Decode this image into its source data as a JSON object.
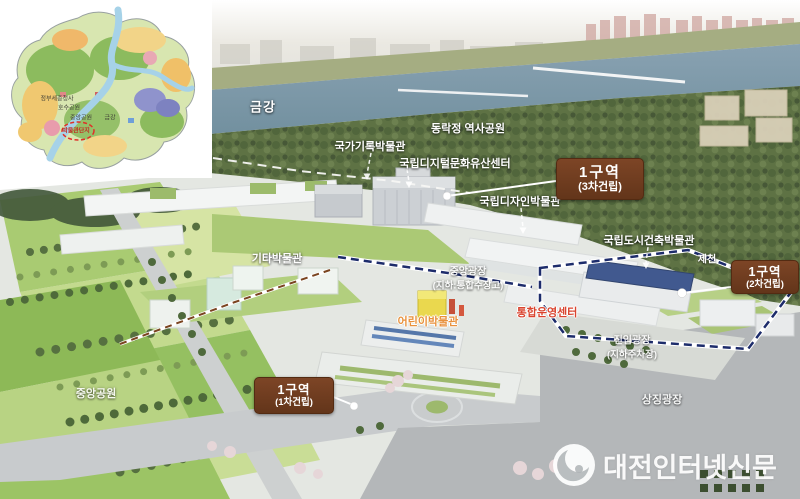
{
  "inset_map": {
    "labels": {
      "government_complex": "정부세종청사",
      "lake_park": "호수공원",
      "central_park": "중앙공원",
      "geum_river": "금강",
      "museum_complex": "박물관단지"
    }
  },
  "labels": {
    "geumgang": {
      "text": "금강"
    },
    "archives_museum": {
      "text": "국가기록박물관"
    },
    "dongnakjeong_park": {
      "text": "동락정 역사공원"
    },
    "digital_heritage_center": {
      "text": "국립디지털문화유산센터"
    },
    "design_museum": {
      "text": "국립디자인박물관"
    },
    "urban_architecture_museum": {
      "text": "국립도시건축박물관"
    },
    "jecheon": {
      "text": "제천"
    },
    "other_museums": {
      "text": "기타박물관"
    },
    "central_plaza": {
      "text": "중앙광장",
      "sub": "(지하:통합수장고)"
    },
    "children_museum": {
      "text": "어린이박물관"
    },
    "operation_center": {
      "text": "통합운영센터"
    },
    "entry_plaza": {
      "text": "진입광장",
      "sub": "(지하주차장)"
    },
    "central_park": {
      "text": "중앙공원"
    },
    "symbol_plaza": {
      "text": "상징광장"
    }
  },
  "zones": {
    "phase3": {
      "title": "1구역",
      "sub": "(3차건립)"
    },
    "phase2": {
      "title": "1구역",
      "sub": "(2차건립)"
    },
    "phase1": {
      "title": "1구역",
      "sub": "(1차건립)"
    }
  },
  "watermark": {
    "text": "대전인터넷신문"
  },
  "colors": {
    "zone_box": "#6e3a1c",
    "boundary_navy": "#1d2c6b",
    "label_orange": "#e8913c",
    "label_red": "#d9442f",
    "river": "#7d98ab",
    "forest": "#5e7244",
    "lawn": "#abc975",
    "plaza_grey": "#b4b7b9",
    "watermark_white": "#ffffff"
  }
}
